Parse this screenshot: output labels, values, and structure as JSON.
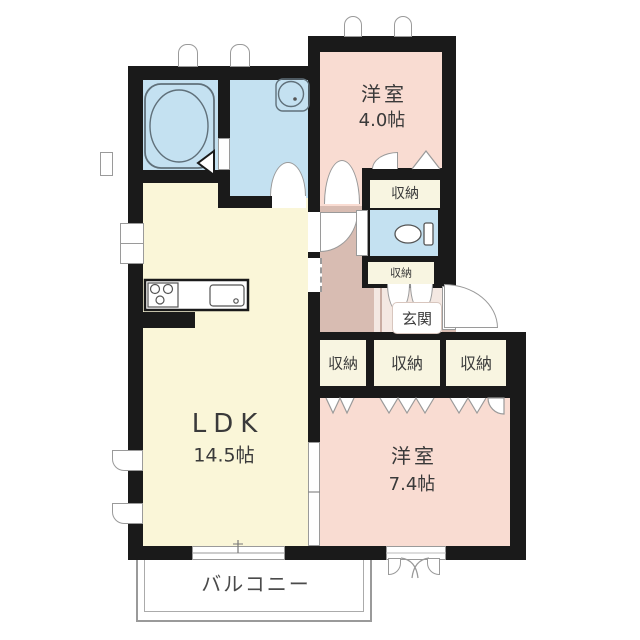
{
  "rooms": {
    "bedroom_top": {
      "name": "洋室",
      "area": "4.0帖"
    },
    "ldk": {
      "name": "LDK",
      "area": "14.5帖"
    },
    "bedroom_bottom": {
      "name": "洋室",
      "area": "7.4帖"
    },
    "entrance": {
      "name": "玄関"
    },
    "balcony": {
      "name": "バルコニー"
    }
  },
  "closets": {
    "top": "収納",
    "hall": "収納",
    "row": [
      "収納",
      "収納",
      "収納"
    ]
  },
  "colors": {
    "wall": "#1a1a1a",
    "wet_area": "#c4e1f1",
    "ldk": "#faf6d8",
    "bedroom": "#f9dcd2",
    "hallway": "#d8bcb2",
    "closet": "#f8f5e1",
    "entrance_floor": "#f4e8e2"
  }
}
